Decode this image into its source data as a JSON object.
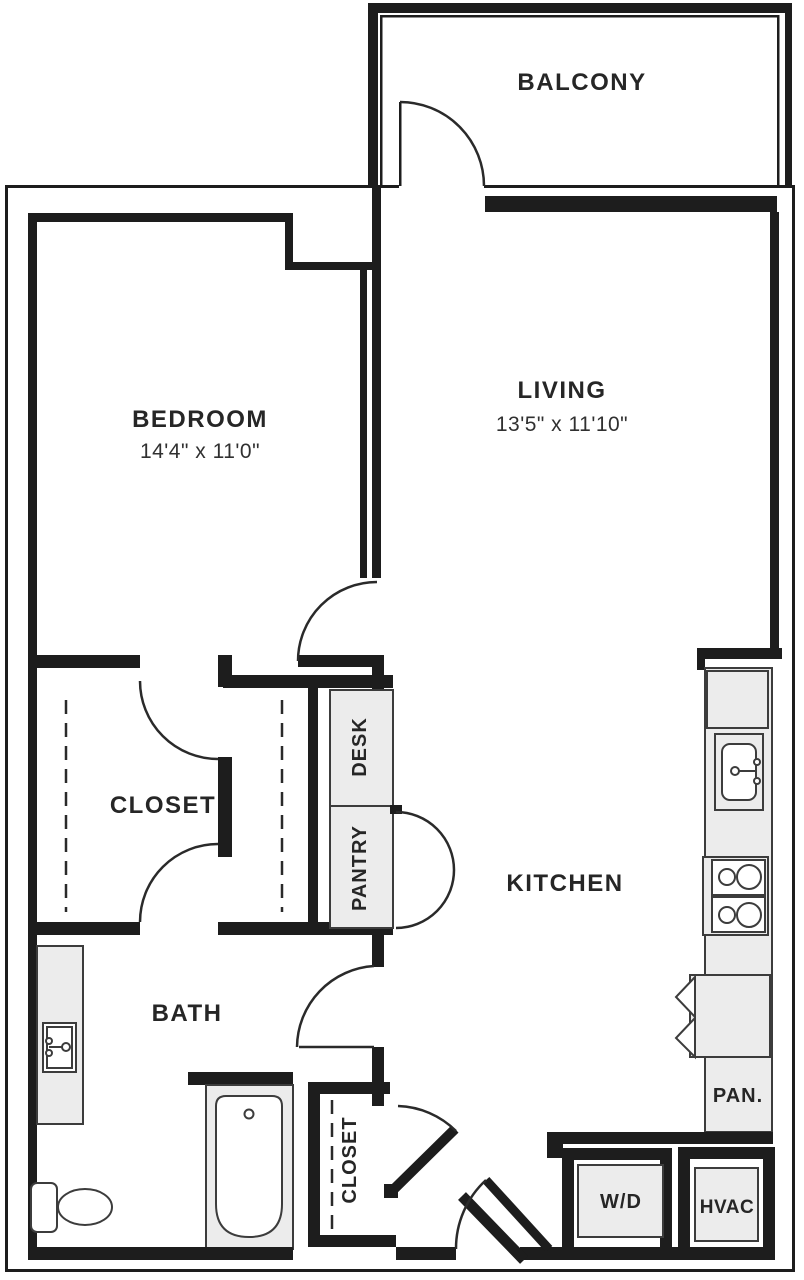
{
  "rooms": {
    "balcony": {
      "label": "BALCONY"
    },
    "bedroom": {
      "label": "BEDROOM",
      "dims": "14'4\" x 11'0\""
    },
    "living": {
      "label": "LIVING",
      "dims": "13'5\" x 11'10\""
    },
    "closet": {
      "label": "CLOSET"
    },
    "desk": {
      "label": "DESK"
    },
    "pantry": {
      "label": "PANTRY"
    },
    "kitchen": {
      "label": "KITCHEN"
    },
    "bath": {
      "label": "BATH"
    },
    "entry_closet": {
      "label": "CLOSET"
    },
    "pantry_small": {
      "label": "PAN."
    },
    "washer_dryer": {
      "label": "W/D"
    },
    "hvac": {
      "label": "HVAC"
    }
  },
  "colors": {
    "wall": "#1d1d1d",
    "fixture_fill": "#ececec",
    "fixture_stroke": "#3c3c3c",
    "text": "#262626",
    "background": "#ffffff"
  }
}
